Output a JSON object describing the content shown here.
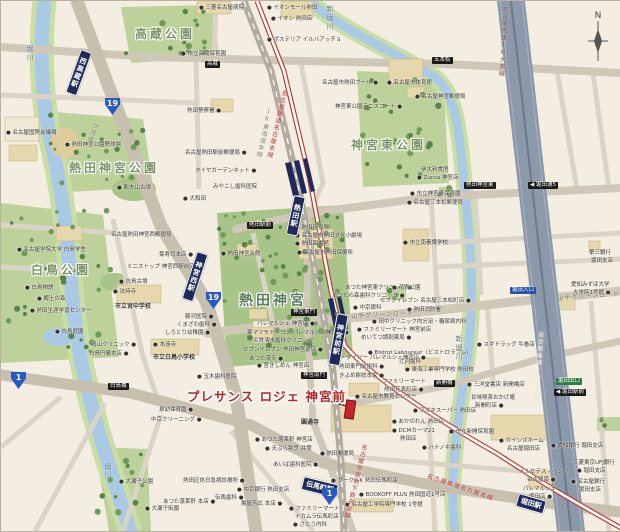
{
  "map": {
    "property": {
      "label": "プレサンス ロジェ 神宮前",
      "x": 186,
      "y": 385,
      "marker": {
        "x": 344,
        "y": 399,
        "w": 8,
        "h": 17
      },
      "pointer": [
        322,
        398,
        345,
        405
      ]
    },
    "compass": {
      "letter": "N",
      "x": 584,
      "y": 10
    },
    "colors": {
      "background": "#f3eee1",
      "park": "#bcd29a",
      "water": "#a9c9e5",
      "road": "#cfc8b8",
      "expressway": "#8b99ab",
      "rail_jr": "#b3ac9e",
      "rail_meitetsu": "#c0392f",
      "station_banner": "#1e2a57",
      "route_shield": "#2b59c3",
      "property_red": "#b5242a",
      "building": "#e6d7ac",
      "sign_black": "#1c1a17",
      "sign_green": "#2e7d46",
      "sign_blue": "#2952a3"
    },
    "area_labels": [
      {
        "t": "高蔵公園",
        "x": 134,
        "y": 24
      },
      {
        "t": "熱田神宮公園",
        "x": 68,
        "y": 158
      },
      {
        "t": "白鳥公園",
        "x": 30,
        "y": 260
      },
      {
        "t": "神宮東公園",
        "x": 350,
        "y": 135
      },
      {
        "t": "熱田神宮",
        "x": 238,
        "y": 289,
        "big": true
      }
    ],
    "water_labels": [
      {
        "t": "堀川",
        "x": 24,
        "y": 44
      },
      {
        "t": "堀川",
        "x": 102,
        "y": 462
      },
      {
        "t": "新堀川",
        "x": 324,
        "y": 4
      },
      {
        "t": "新堀川",
        "x": 453,
        "y": 334
      }
    ],
    "line_labels": [
      {
        "t": "名古屋鉄道名古屋本線",
        "x": 279,
        "y": 88,
        "vert": true,
        "rot": 13,
        "c": "#b03030"
      },
      {
        "t": "JR東海道本線",
        "x": 264,
        "y": 106,
        "vert": true,
        "rot": 13,
        "c": "#8a857a"
      },
      {
        "t": "名古屋高速3号大高線",
        "x": 499,
        "y": 5,
        "vert": true,
        "rot": 3,
        "c": "#77504a"
      },
      {
        "t": "名古屋高速3号大高線",
        "x": 535,
        "y": 330,
        "vert": true,
        "rot": 4,
        "c": "#e9e2d0"
      },
      {
        "t": "名古屋市営地下鉄名城線",
        "x": 359,
        "y": 442,
        "vert": true,
        "rot": 14,
        "c": "#b03030"
      },
      {
        "t": "名古屋鉄道名古屋本線",
        "x": 428,
        "y": 470,
        "vert": false,
        "rot": 19,
        "c": "#b03030"
      },
      {
        "t": "伏見通",
        "x": 91,
        "y": 120,
        "vert": true,
        "rot": 22,
        "c": "#8a857a"
      },
      {
        "t": "山手グリーンロード",
        "x": 350,
        "y": 310,
        "vert": false,
        "rot": -3,
        "c": "#7a756a"
      },
      {
        "t": "山手グリーンロード",
        "x": 556,
        "y": 292,
        "vert": false,
        "rot": -4,
        "c": "#7a756a"
      }
    ],
    "stations": [
      {
        "name": "西高蔵駅",
        "x": 80,
        "y": 48,
        "vert": true,
        "rot": 20,
        "h": 40
      },
      {
        "name": "神宮西駅",
        "x": 196,
        "y": 250,
        "vert": true,
        "rot": 18,
        "h": 44
      },
      {
        "name": "熱田駅",
        "x": 293,
        "y": 194,
        "vert": true,
        "rot": 12,
        "h": 34
      },
      {
        "name": "神宮前駅",
        "x": 336,
        "y": 312,
        "vert": true,
        "rot": 10,
        "h": 46
      },
      {
        "name": "伝馬町駅",
        "x": 303,
        "y": 475,
        "vert": false,
        "rot": 14,
        "h": 12
      },
      {
        "name": "堀田駅",
        "x": 518,
        "y": 492,
        "vert": false,
        "rot": 16,
        "h": 12
      }
    ],
    "signs": [
      {
        "t": "高蔵",
        "x": 204,
        "y": 60,
        "c": "black"
      },
      {
        "t": "五本松",
        "x": 431,
        "y": 56,
        "c": "black"
      },
      {
        "t": "熱田駅前",
        "x": 246,
        "y": 221,
        "c": "black"
      },
      {
        "t": "熱田神宮東",
        "x": 463,
        "y": 181,
        "c": "black"
      },
      {
        "t": "◀ 堀田通5",
        "x": 527,
        "y": 181,
        "c": "black"
      },
      {
        "t": "神宮東門",
        "x": 290,
        "y": 308,
        "c": "black"
      },
      {
        "t": "神宮南門",
        "x": 300,
        "y": 371,
        "c": "black"
      },
      {
        "t": "白鳥橋",
        "x": 107,
        "y": 382,
        "c": "black"
      },
      {
        "t": "新開橋",
        "x": 433,
        "y": 379,
        "c": "black"
      },
      {
        "t": "堀田出口",
        "x": 555,
        "y": 377,
        "c": "green"
      },
      {
        "t": "◀ 堀田駅前",
        "x": 553,
        "y": 388,
        "c": "black"
      },
      {
        "t": "堀田入口",
        "x": 509,
        "y": 286,
        "c": "blue"
      }
    ],
    "route_shields": [
      {
        "n": "19",
        "x": 104,
        "y": 97
      },
      {
        "n": "19",
        "x": 205,
        "y": 291
      },
      {
        "n": "1",
        "x": 10,
        "y": 371
      },
      {
        "n": "1",
        "x": 321,
        "y": 487
      }
    ],
    "poi_labels": [
      {
        "t": "● 三菱名古屋病院",
        "x": 198,
        "y": 4
      },
      {
        "t": "● イオンモール熱田",
        "x": 266,
        "y": 4
      },
      {
        "t": "● イオン 熱田店",
        "x": 270,
        "y": 15
      },
      {
        "t": "● ポステリア イルバアッチョ",
        "x": 266,
        "y": 36
      },
      {
        "t": "● 市立高蔵保育園",
        "x": 180,
        "y": 50
      },
      {
        "t": "熱田警察署 ●",
        "x": 186,
        "y": 107
      },
      {
        "t": "名古屋熱田駅前郵便局 ●",
        "x": 184,
        "y": 149
      },
      {
        "t": "タイヤガーデンネット ●",
        "x": 194,
        "y": 167
      },
      {
        "t": "● 名古屋国際会議場",
        "x": 5,
        "y": 129
      },
      {
        "t": "● 熱田神宮公園野球場",
        "x": 64,
        "y": 141
      },
      {
        "t": "● 断夫山古墳",
        "x": 116,
        "y": 184
      },
      {
        "t": "みやこし歯科医院",
        "x": 212,
        "y": 183
      },
      {
        "t": "● 大和田",
        "x": 182,
        "y": 195
      },
      {
        "t": "名古屋熱田神宮西郵便局",
        "x": 110,
        "y": 231
      },
      {
        "t": "菊寿司本店 ●",
        "x": 158,
        "y": 251
      },
      {
        "t": "ミニストップ 神宮西駅前店 ●",
        "x": 126,
        "y": 263
      },
      {
        "t": "● 白鳥古墳",
        "x": 118,
        "y": 278
      },
      {
        "t": "● 法持寺",
        "x": 112,
        "y": 288
      },
      {
        "t": "● 名古屋学院大学 白鳥学舎",
        "x": 16,
        "y": 246
      },
      {
        "t": "● 白鳥物語",
        "x": 24,
        "y": 284
      },
      {
        "t": "● 郷土の森",
        "x": 36,
        "y": 295
      },
      {
        "t": "● 熱田生涯学習センター",
        "x": 29,
        "y": 307
      },
      {
        "t": "● 白鳥庭園",
        "x": 54,
        "y": 328
      },
      {
        "t": "市立宮中学校",
        "x": 114,
        "y": 303,
        "b": true
      },
      {
        "t": "藤沢医院 ●",
        "x": 184,
        "y": 313
      },
      {
        "t": "くまざわ歯科 ●",
        "x": 176,
        "y": 321
      },
      {
        "t": "しろとり幼稚園 ●",
        "x": 164,
        "y": 329
      },
      {
        "t": "岡山クリニック ●",
        "x": 90,
        "y": 341
      },
      {
        "t": "白鳥円藤本店 ●",
        "x": 88,
        "y": 350
      },
      {
        "t": "● 本遠寺",
        "x": 152,
        "y": 341
      },
      {
        "t": "市立白鳥小学校",
        "x": 152,
        "y": 354,
        "b": true
      },
      {
        "t": "● 玉木歯科医院",
        "x": 196,
        "y": 373
      },
      {
        "t": "泉幼保育園 ●",
        "x": 158,
        "y": 406
      },
      {
        "t": "中京クリーニング ●",
        "x": 150,
        "y": 416
      },
      {
        "t": "● 大瀬子公園",
        "x": 118,
        "y": 478
      },
      {
        "t": "● 大瀬子街園",
        "x": 144,
        "y": 505
      },
      {
        "t": "熱田区休日急病診療所 ●",
        "x": 182,
        "y": 477
      },
      {
        "t": "● 中京銀行 熱田支店",
        "x": 236,
        "y": 486
      },
      {
        "t": "伝馬歯科 ●",
        "x": 214,
        "y": 494
      },
      {
        "t": "あつた蓬莱軒 本店 ●",
        "x": 162,
        "y": 498
      },
      {
        "t": "亀屋芳広 本店 ●",
        "x": 240,
        "y": 500
      },
      {
        "t": "あいば歯科医院 ●",
        "x": 272,
        "y": 461
      },
      {
        "t": "● 天ぷら割烹 井筒",
        "x": 264,
        "y": 445
      },
      {
        "t": "● あつた蓬莱軒 神宮店",
        "x": 254,
        "y": 436
      },
      {
        "t": "圓通寺",
        "x": 300,
        "y": 419,
        "b": true
      },
      {
        "t": "● 宮きしめん 神宮店",
        "x": 256,
        "y": 362
      },
      {
        "t": "ザ・ダイソー パレマルシェ神宮店 ●",
        "x": 334,
        "y": 354
      },
      {
        "t": "熱田東門前歯科 ●",
        "x": 338,
        "y": 363
      },
      {
        "t": "きよめ餅総本家 ●",
        "x": 338,
        "y": 372
      },
      {
        "t": "パレマルシェ 神宮店 ●",
        "x": 256,
        "y": 320
      },
      {
        "t": "薬マツモトキヨシ パレマルシェ神宮店 ●",
        "x": 246,
        "y": 329
      },
      {
        "t": "名鉄清水歯科クリニック",
        "x": 252,
        "y": 337
      },
      {
        "t": "セブンイレブン 熱田神宮前店 ●",
        "x": 242,
        "y": 346
      },
      {
        "t": "あつた茶天 ●",
        "x": 248,
        "y": 355
      },
      {
        "t": "● 熱田神宮会館",
        "x": 220,
        "y": 250
      },
      {
        "t": "● 熱田区役所",
        "x": 294,
        "y": 224
      },
      {
        "t": "● 名古屋市熱田文化小劇場",
        "x": 294,
        "y": 232
      },
      {
        "t": "● 熱田図書館",
        "x": 294,
        "y": 240
      },
      {
        "t": "● 名古屋市熱田保健所",
        "x": 296,
        "y": 249
      },
      {
        "t": "あつた神宮東クリニック ●",
        "x": 344,
        "y": 284
      },
      {
        "t": "あつたの森歯科クリニック ●",
        "x": 331,
        "y": 292
      },
      {
        "t": "● 中京眼科",
        "x": 352,
        "y": 304
      },
      {
        "t": "● 田中クリニック内分泌・糖尿病内科",
        "x": 371,
        "y": 318
      },
      {
        "t": "● ファミリーマート 神宮前店",
        "x": 356,
        "y": 326
      },
      {
        "t": "めいてつ調剤薬局 ●",
        "x": 360,
        "y": 334
      },
      {
        "t": "● Bistrot Laboureur（ビストロラブレ）",
        "x": 367,
        "y": 349
      },
      {
        "t": "辻河歯科",
        "x": 398,
        "y": 358
      },
      {
        "t": "● スギドラッグ 牛巻店",
        "x": 476,
        "y": 341
      },
      {
        "t": "● 市立神宮東保育園",
        "x": 409,
        "y": 190
      },
      {
        "t": "● 名古屋三本松郵便局",
        "x": 406,
        "y": 199
      },
      {
        "t": "● 市立南養護学校",
        "x": 402,
        "y": 239
      },
      {
        "t": "● 花表公園",
        "x": 391,
        "y": 284
      },
      {
        "t": "セブンイレブン 名古屋三本松町店 ●",
        "x": 379,
        "y": 297
      },
      {
        "t": "● 熱田消防署",
        "x": 406,
        "y": 306
      },
      {
        "t": "名古屋市熱田プール ●",
        "x": 321,
        "y": 79
      },
      {
        "t": "● 名古屋市体育館",
        "x": 386,
        "y": 79
      },
      {
        "t": "● 名古屋神宮郵便局",
        "x": 414,
        "y": 93
      },
      {
        "t": "神宮東公園テニスコート ●",
        "x": 334,
        "y": 103
      },
      {
        "t": "伊太利食房",
        "x": 420,
        "y": 166
      },
      {
        "t": "● Zucca 神宮店",
        "x": 416,
        "y": 174
      },
      {
        "t": "第三銀行",
        "x": 588,
        "y": 249
      },
      {
        "t": "堀田支店",
        "x": 590,
        "y": 257
      },
      {
        "t": "愛知みずほ大学",
        "x": 570,
        "y": 281
      },
      {
        "t": "大学院1号館 ●",
        "x": 572,
        "y": 289
      },
      {
        "t": "● カインズホーム",
        "x": 498,
        "y": 437
      },
      {
        "t": "名古屋堀田店",
        "x": 506,
        "y": 445
      },
      {
        "t": "● 愛知銀行 堀田支店",
        "x": 550,
        "y": 442
      },
      {
        "t": "三菱東京UFJ銀行",
        "x": 572,
        "y": 459
      },
      {
        "t": "● 堀田支店",
        "x": 576,
        "y": 467
      },
      {
        "t": "● 名古屋銀行",
        "x": 570,
        "y": 478
      },
      {
        "t": "堀田支店",
        "x": 578,
        "y": 486
      },
      {
        "t": "メルセデス・ベンツ",
        "x": 518,
        "y": 468
      },
      {
        "t": "名古屋南 ●",
        "x": 526,
        "y": 476
      },
      {
        "t": "パレマルシェ",
        "x": 522,
        "y": 485
      },
      {
        "t": "堀田店 ●",
        "x": 528,
        "y": 493
      },
      {
        "t": "● 市立新開保育園",
        "x": 448,
        "y": 428
      },
      {
        "t": "● ハナノキ歯科",
        "x": 421,
        "y": 444
      },
      {
        "t": "● DCMカーマ21",
        "x": 391,
        "y": 427
      },
      {
        "t": "熱田店",
        "x": 399,
        "y": 435
      },
      {
        "t": "● あかのれん 熱田店",
        "x": 391,
        "y": 418
      },
      {
        "t": "● アオキスーパー 熱田店",
        "x": 412,
        "y": 407
      },
      {
        "t": "甘味喫茶おかげ庵",
        "x": 470,
        "y": 394
      },
      {
        "t": "新開町店 ●",
        "x": 474,
        "y": 402
      },
      {
        "t": "● 三洋堂書店 新開橋店",
        "x": 466,
        "y": 381
      },
      {
        "t": "● 東海工業専門学校 熱田校",
        "x": 404,
        "y": 366
      },
      {
        "t": "ファミリーマート",
        "x": 381,
        "y": 378
      },
      {
        "t": "熱田花表町店 ●",
        "x": 383,
        "y": 386
      },
      {
        "t": "● 名古屋市教育センター",
        "x": 354,
        "y": 393
      },
      {
        "t": "● 熱田郵便局",
        "x": 319,
        "y": 450
      },
      {
        "t": "● サークルK 熱田伝馬町店",
        "x": 330,
        "y": 477
      },
      {
        "t": "● BOOKOFF PLUS 熱田国道1号店",
        "x": 358,
        "y": 491
      },
      {
        "t": "● 名古屋工学院専門学校 1号館",
        "x": 344,
        "y": 501
      },
      {
        "t": "● ファミリーマート",
        "x": 288,
        "y": 505
      },
      {
        "t": "ナカムラ伝馬町店",
        "x": 294,
        "y": 513
      },
      {
        "t": "● さとう内科",
        "x": 292,
        "y": 521
      }
    ]
  }
}
